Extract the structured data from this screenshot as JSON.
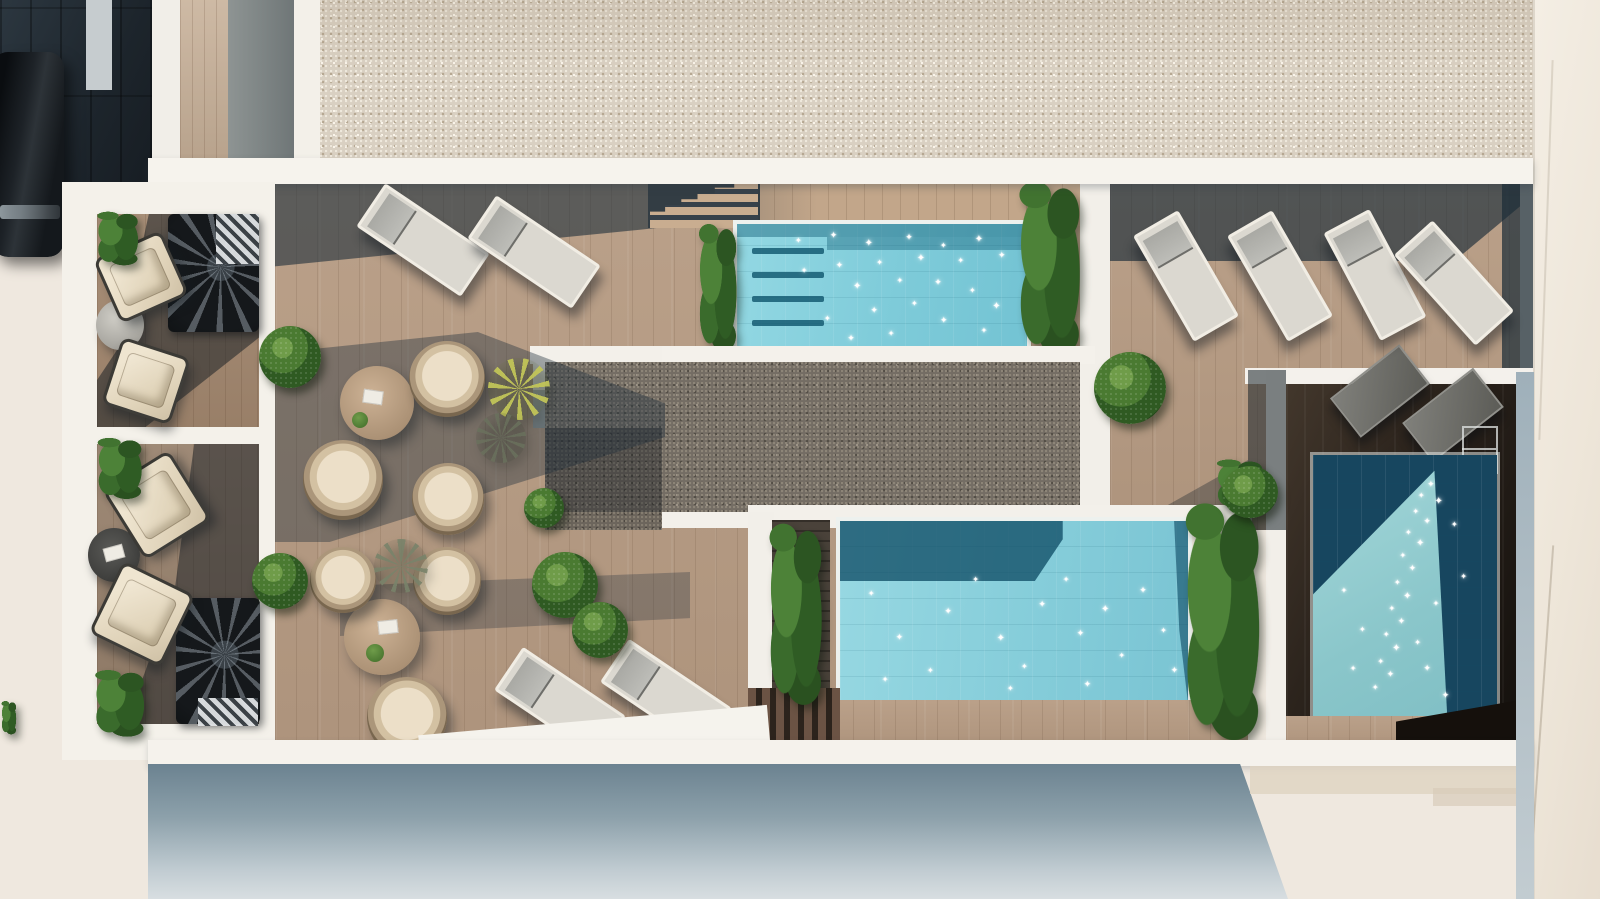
{
  "meta": {
    "title": "Aerial 3D render of a rooftop pool terrace with three pools, timber sun decks and two private terraces",
    "view": "top-down aerial",
    "lighting": "sunny daylight with long hard shadows"
  },
  "labels": {
    "street": "Street with dark block paving",
    "car": "Dark parked car",
    "gravel_roof": "Light gravel flat roof strip",
    "right_building": "Neighbouring white building",
    "main_deck": "Timber sun deck with loungers and rattan seating groups",
    "right_deck": "Sun deck with four aligned loungers",
    "top_pool": "Upper swimming pool with entry steps and flanking planters",
    "bottom_pool": "Lower swimming pool with shaded corner",
    "plunge_pool": "Shaded plunge pool with triangular sun patch and ladder",
    "gravel_court": "Dark gravel centre court",
    "terrace1": "Private terrace with two armchairs, round table and spiral staircase",
    "terrace2": "Private terrace with two armchairs, round table and spiral staircase",
    "facade": "Building facade falling away below the terrace",
    "forecourt": "Sunlit cream forecourt with cast shadows"
  },
  "counts": {
    "pools": 3,
    "sun_loungers": 12,
    "rattan_chairs": 6,
    "armchairs": 4,
    "round_tables": 4,
    "spiral_staircases": 2
  },
  "palette": {
    "deck_wood": "#b69b83",
    "dark_deck": "#2b231c",
    "pool_light": "#84cdd9",
    "pool_dark": "#17465f",
    "gravel_light": "#d9d0c2",
    "gravel_dark": "#746d64",
    "white_wall": "#f4f1ec",
    "pavement": "#3e4c57",
    "greenery": "#3a6b2c"
  },
  "sparkles": {
    "top_pool": [
      [
        20,
        10,
        8
      ],
      [
        32,
        6,
        9
      ],
      [
        44,
        12,
        10
      ],
      [
        58,
        8,
        9
      ],
      [
        70,
        14,
        8
      ],
      [
        82,
        9,
        10
      ],
      [
        90,
        22,
        9
      ],
      [
        76,
        26,
        8
      ],
      [
        62,
        24,
        10
      ],
      [
        48,
        28,
        8
      ],
      [
        34,
        30,
        9
      ],
      [
        22,
        34,
        8
      ],
      [
        40,
        46,
        10
      ],
      [
        55,
        42,
        8
      ],
      [
        68,
        44,
        9
      ],
      [
        80,
        50,
        8
      ],
      [
        88,
        62,
        10
      ],
      [
        60,
        60,
        8
      ],
      [
        46,
        66,
        9
      ],
      [
        30,
        72,
        8
      ],
      [
        70,
        74,
        9
      ],
      [
        52,
        84,
        8
      ],
      [
        38,
        88,
        9
      ],
      [
        84,
        82,
        8
      ]
    ],
    "bottom_pool": [
      [
        8,
        38,
        8
      ],
      [
        16,
        62,
        9
      ],
      [
        25,
        80,
        8
      ],
      [
        30,
        48,
        9
      ],
      [
        38,
        30,
        8
      ],
      [
        45,
        62,
        10
      ],
      [
        52,
        78,
        8
      ],
      [
        57,
        44,
        9
      ],
      [
        64,
        30,
        8
      ],
      [
        68,
        60,
        9
      ],
      [
        75,
        46,
        10
      ],
      [
        80,
        72,
        8
      ],
      [
        86,
        36,
        9
      ],
      [
        92,
        58,
        8
      ],
      [
        95,
        80,
        9
      ],
      [
        12,
        85,
        8
      ],
      [
        48,
        90,
        8
      ],
      [
        70,
        88,
        9
      ]
    ],
    "right_pool": [
      [
        62,
        10,
        9
      ],
      [
        57,
        14,
        8
      ],
      [
        66,
        16,
        10
      ],
      [
        54,
        20,
        8
      ],
      [
        60,
        24,
        9
      ],
      [
        50,
        28,
        8
      ],
      [
        56,
        32,
        10
      ],
      [
        47,
        37,
        8
      ],
      [
        52,
        42,
        9
      ],
      [
        44,
        47,
        8
      ],
      [
        49,
        52,
        10
      ],
      [
        41,
        57,
        8
      ],
      [
        46,
        62,
        9
      ],
      [
        38,
        67,
        8
      ],
      [
        43,
        72,
        10
      ],
      [
        35,
        77,
        8
      ],
      [
        40,
        82,
        9
      ],
      [
        32,
        87,
        8
      ],
      [
        55,
        70,
        8
      ],
      [
        60,
        80,
        9
      ],
      [
        25,
        65,
        8
      ],
      [
        20,
        80,
        8
      ],
      [
        65,
        55,
        8
      ],
      [
        70,
        90,
        9
      ],
      [
        15,
        50,
        8
      ],
      [
        75,
        25,
        8
      ],
      [
        80,
        45,
        8
      ]
    ]
  }
}
